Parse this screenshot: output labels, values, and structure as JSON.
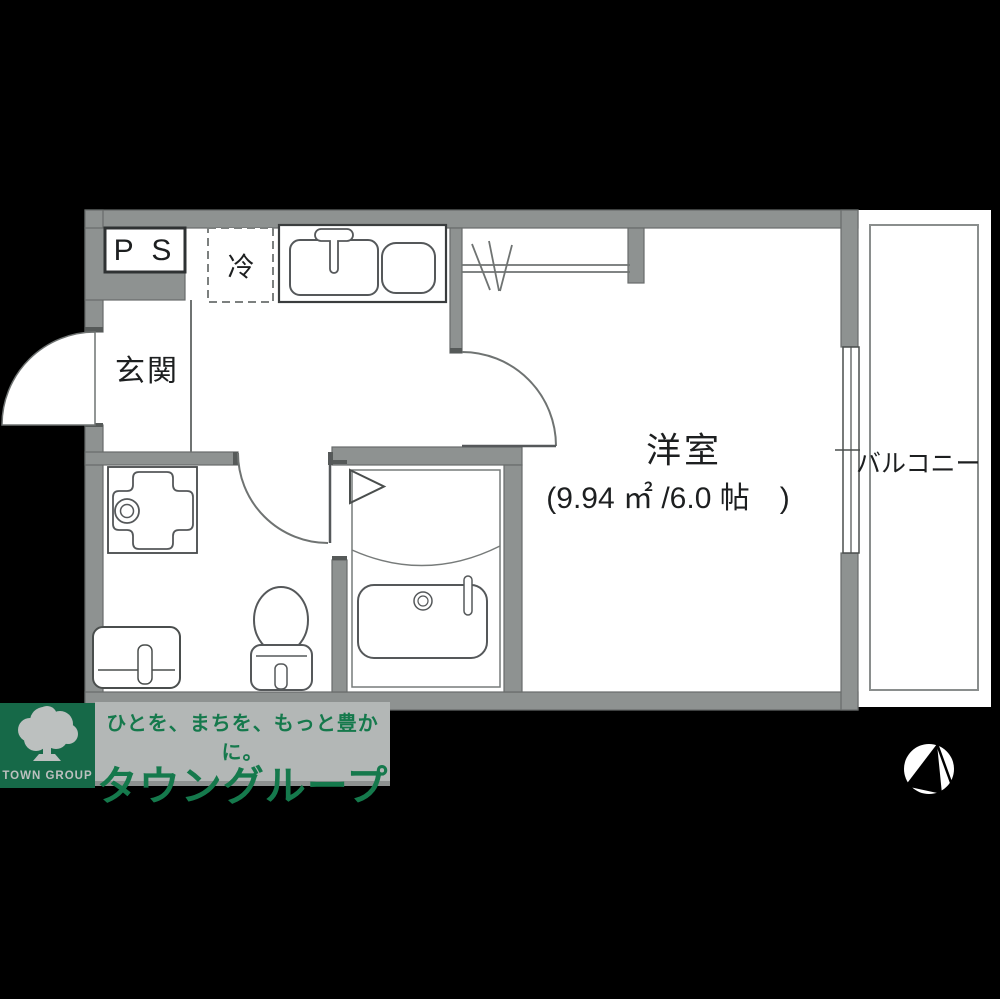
{
  "floor_plan": {
    "labels": {
      "ps": "P S",
      "fridge": "冷",
      "entrance": "玄関",
      "western_room": "洋室",
      "western_room_size": "(9.94 ㎡ /6.0 帖　)",
      "balcony": "バルコニー"
    },
    "colors": {
      "background": "#000000",
      "floor": "#ffffff",
      "wall_gray": "#8e9291",
      "thin_line": "#6f7372",
      "fixture_line": "#55585a"
    }
  },
  "footer": {
    "logo_text": "TOWN GROUP",
    "tagline": "ひとを、まちを、もっと豊かに。",
    "company": "タウングループ",
    "colors": {
      "logo_green": "#166948",
      "text_green": "#15794c",
      "band_gray": "#b3b7b6"
    }
  }
}
